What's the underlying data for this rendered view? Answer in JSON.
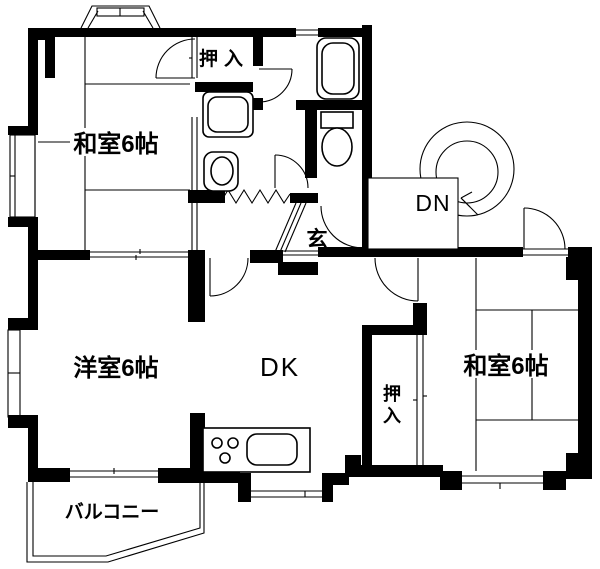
{
  "title": "2DK apartment floor plan",
  "colors": {
    "wall": "#000000",
    "background": "#ffffff",
    "line": "#000000"
  },
  "rooms": {
    "washitsu_top_left": {
      "label": "和室6帖"
    },
    "oshiire_top": {
      "label": "押入"
    },
    "yoshitsu": {
      "label": "洋室6帖"
    },
    "dk": {
      "label": "DK"
    },
    "washitsu_bottom_right": {
      "label": "和室6帖"
    },
    "oshiire_right": {
      "label": "押入",
      "char1": "押",
      "char2": "入"
    },
    "genkan": {
      "label": "玄"
    },
    "stairs_down": {
      "label": "DN"
    },
    "balcony": {
      "label": "バルコニー"
    }
  },
  "fixtures": [
    "bathtub",
    "toilet",
    "wash-basin",
    "washing-machine-pan",
    "kitchen-counter",
    "kitchen-sink",
    "stove-burners",
    "spiral-staircase",
    "bay-window",
    "balcony"
  ]
}
